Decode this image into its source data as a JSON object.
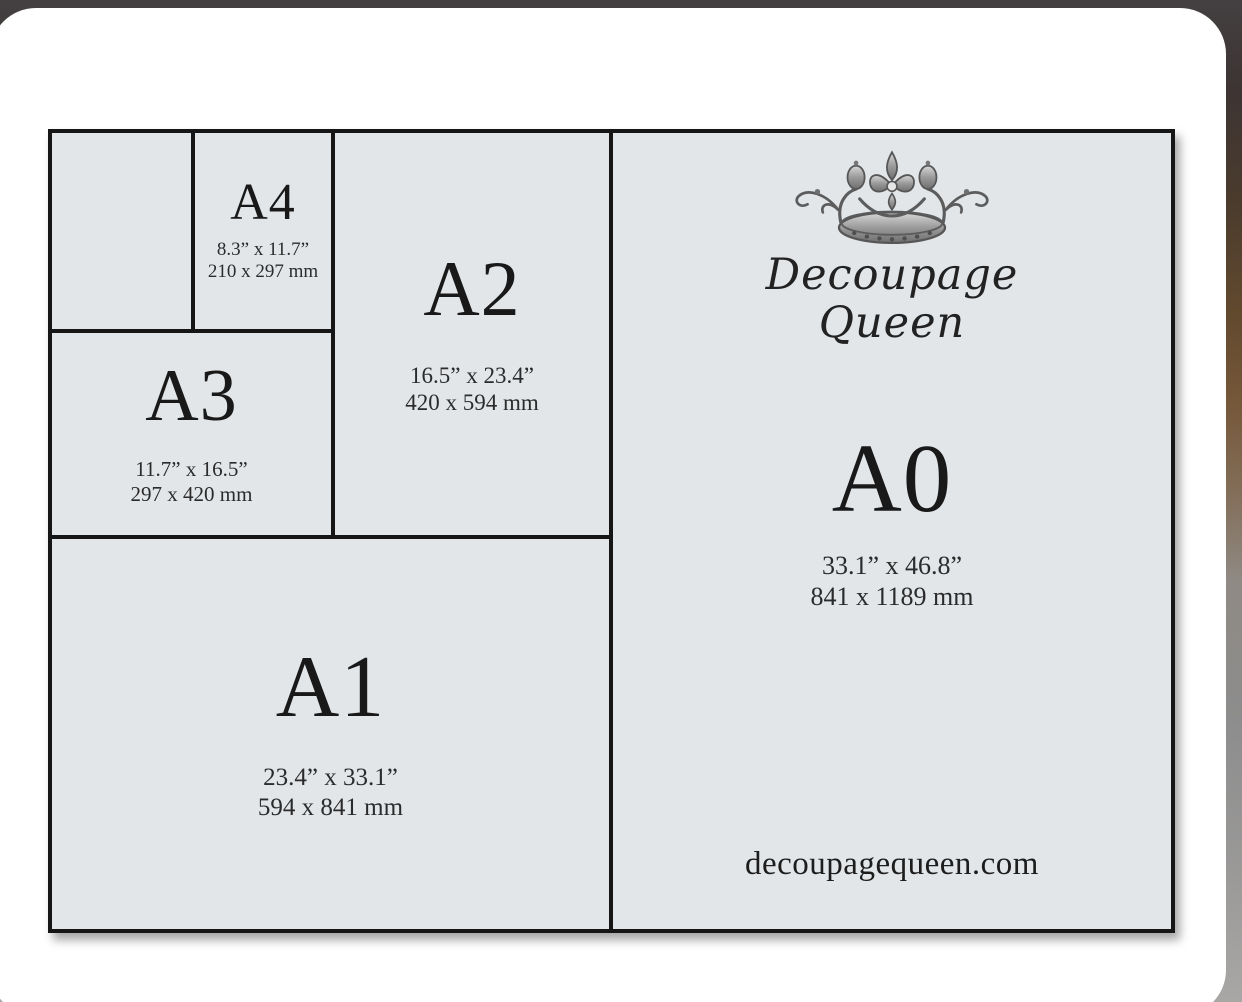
{
  "diagram": {
    "panels": {
      "a4": {
        "label": "A4",
        "inches": "8.3” x 11.7”",
        "mm": "210 x 297 mm"
      },
      "a2": {
        "label": "A2",
        "inches": "16.5” x 23.4”",
        "mm": "420 x 594 mm"
      },
      "a3": {
        "label": "A3",
        "inches": "11.7” x 16.5”",
        "mm": "297 x 420 mm"
      },
      "a1": {
        "label": "A1",
        "inches": "23.4” x 33.1”",
        "mm": "594 x 841 mm"
      },
      "a0": {
        "label": "A0",
        "inches": "33.1” x 46.8”",
        "mm": "841 x 1189 mm"
      }
    },
    "brand": {
      "logo": "crown-icon",
      "name_line1": "Decoupage",
      "name_line2": "Queen",
      "website": "decoupagequeen.com"
    },
    "colors": {
      "panel_background": "#e2e6e9",
      "line": "#161616",
      "text": "#1b1b1b",
      "card": "#ffffff"
    }
  }
}
